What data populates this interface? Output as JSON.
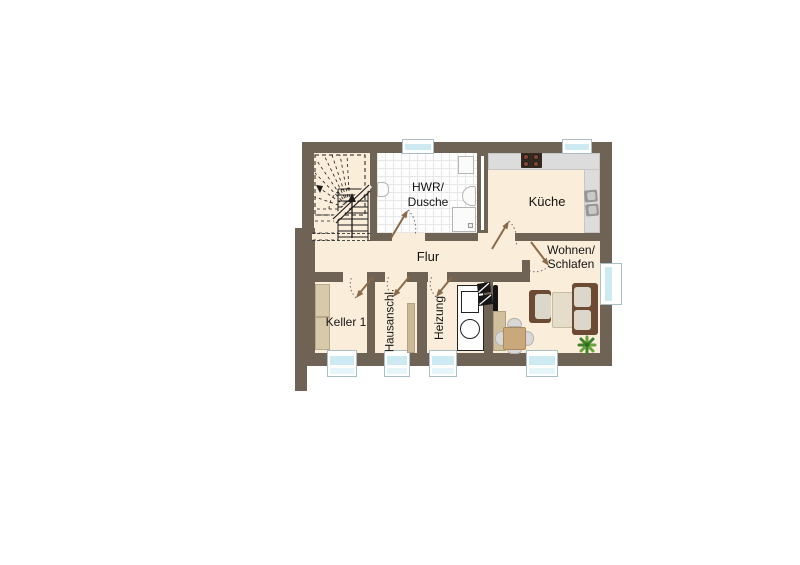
{
  "page": {
    "background_color": "#ffffff"
  },
  "floorplan": {
    "type": "basement-floor-plan",
    "colors": {
      "wall": "#6f6355",
      "floor": "#faeedb",
      "tile": "#fdfdfd",
      "tile_line": "#e7e7e7",
      "counter": "#dcdcdc",
      "window_glass": "#cdeaf3",
      "window_frame": "#ffffff",
      "door_arrow": "#8a6a48",
      "furniture_wood": "#6d4a34",
      "furniture_cushion": "#dbd7cb",
      "furniture_tan": "#c9a87c",
      "plant_green": "#5f9c3d"
    },
    "rooms": {
      "hwr": {
        "label_line1": "HWR/",
        "label_line2": "Dusche"
      },
      "kueche": {
        "label": "Küche"
      },
      "flur": {
        "label": "Flur"
      },
      "wohnen_schlafen": {
        "label_line1": "Wohnen/",
        "label_line2": "Schlafen"
      },
      "keller": {
        "label": "Keller 1"
      },
      "hausanschluss": {
        "label": "Hausanschl."
      },
      "heizung": {
        "label": "Heizung"
      }
    },
    "fixtures": [
      "staircase",
      "washbasin",
      "washing-machine",
      "hand-basin",
      "shower-tray",
      "stove",
      "kitchen-counter",
      "kitchen-sink",
      "boiler",
      "water-tank",
      "chimney",
      "tv",
      "sideboard",
      "dining-table",
      "chairs",
      "armchair",
      "coffee-table",
      "sofa",
      "plant",
      "storage-shelves",
      "windows",
      "door-swings"
    ]
  }
}
